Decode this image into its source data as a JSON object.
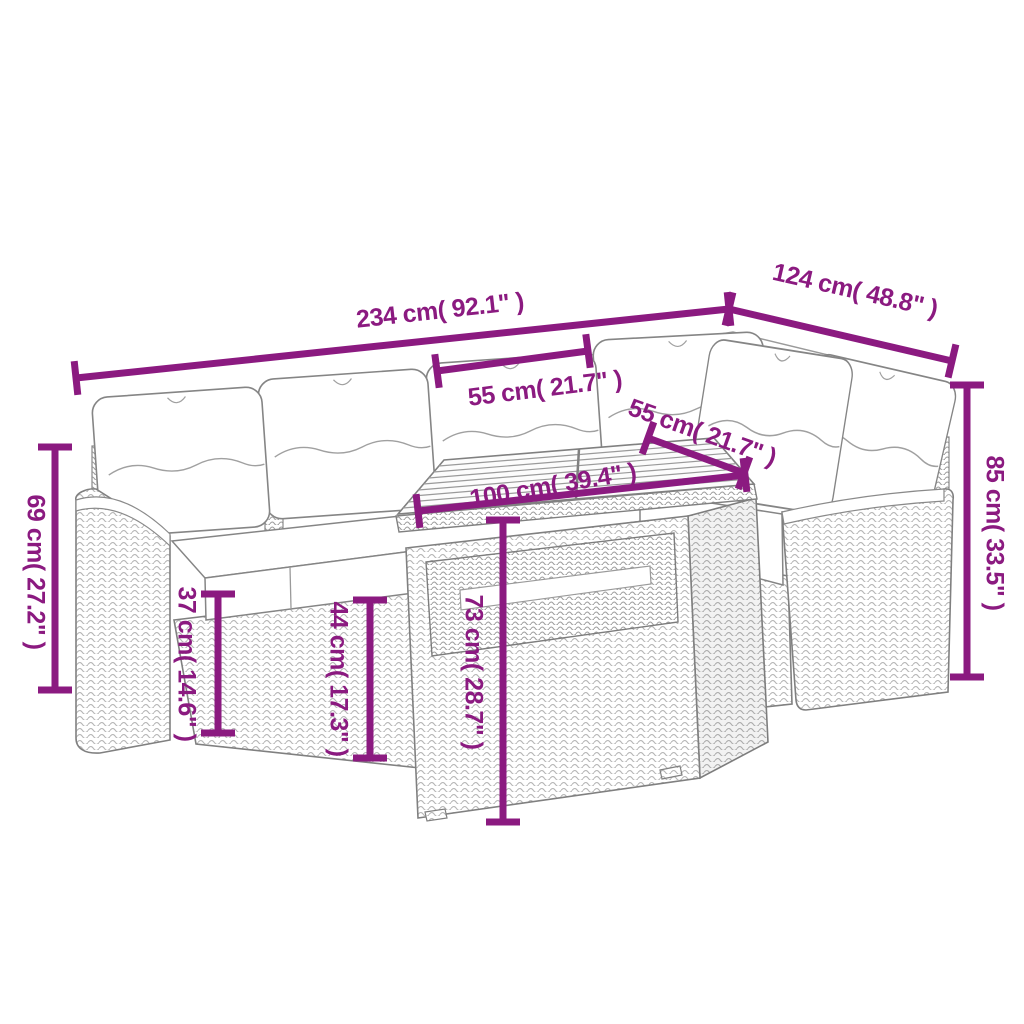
{
  "diagram_type": "furniture-dimension-diagram",
  "product": "rattan-garden-corner-sofa-set-with-table",
  "colors": {
    "dimension_accent": "#8B1A80",
    "line_art": "#808080",
    "background": "#ffffff"
  },
  "labels": {
    "overall_width": "234 cm( 92.1\" )",
    "right_section_depth": "124 cm( 48.8\" )",
    "seat_width": "55 cm( 21.7\" )",
    "table_depth": "55 cm( 21.7\" )",
    "table_length": "100 cm( 39.4\" )",
    "back_height": "85 cm( 33.5\" )",
    "armrest_height": "69 cm( 27.2\" )",
    "seat_height": "37 cm( 14.6\" )",
    "seat_cushion_height": "44 cm( 17.3\" )",
    "table_height": "73 cm( 28.7\" )"
  }
}
